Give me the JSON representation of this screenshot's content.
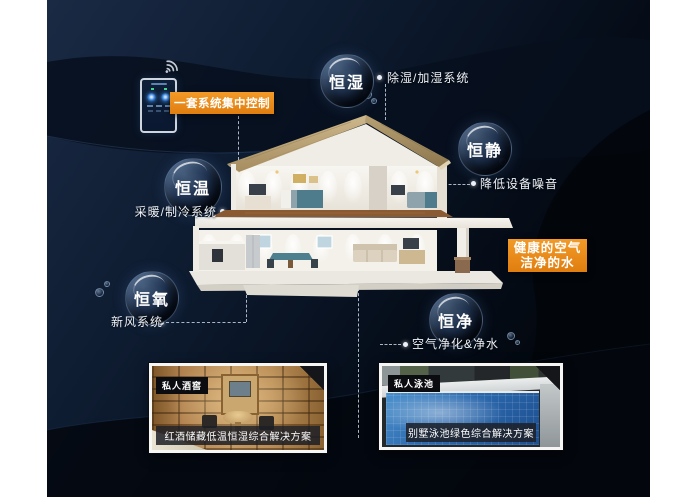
{
  "header": {
    "control_banner": "一套系统集中控制",
    "benefit_line1": "健康的空气",
    "benefit_line2": "洁净的水"
  },
  "bubbles": [
    {
      "label": "恒湿",
      "system": "除湿/加湿系统"
    },
    {
      "label": "恒静",
      "system": "降低设备噪音"
    },
    {
      "label": "恒温",
      "system": "采暖/制冷系统"
    },
    {
      "label": "恒氧",
      "system": "新风系统"
    },
    {
      "label": "恒净",
      "system": "空气净化&净水"
    }
  ],
  "cards": [
    {
      "badge": "私人酒窖",
      "caption": "红酒储藏低温恒湿综合解决方案"
    },
    {
      "badge": "私人泳池",
      "caption": "别墅泳池绿色综合解决方案"
    }
  ],
  "icons": {
    "wifi": "wifi-icon",
    "controller": "smart-controller-phone-icon"
  },
  "colors": {
    "accent_orange": "#e98b1b",
    "background_navy": "#0e1c31",
    "background_black": "#03070e",
    "bubble_text": "#ffffff",
    "caption_bg": "#1c1e26",
    "pool_blue": "#2d6bb0",
    "wood_tan": "#b28350",
    "roof_tan": "#b7a173"
  }
}
